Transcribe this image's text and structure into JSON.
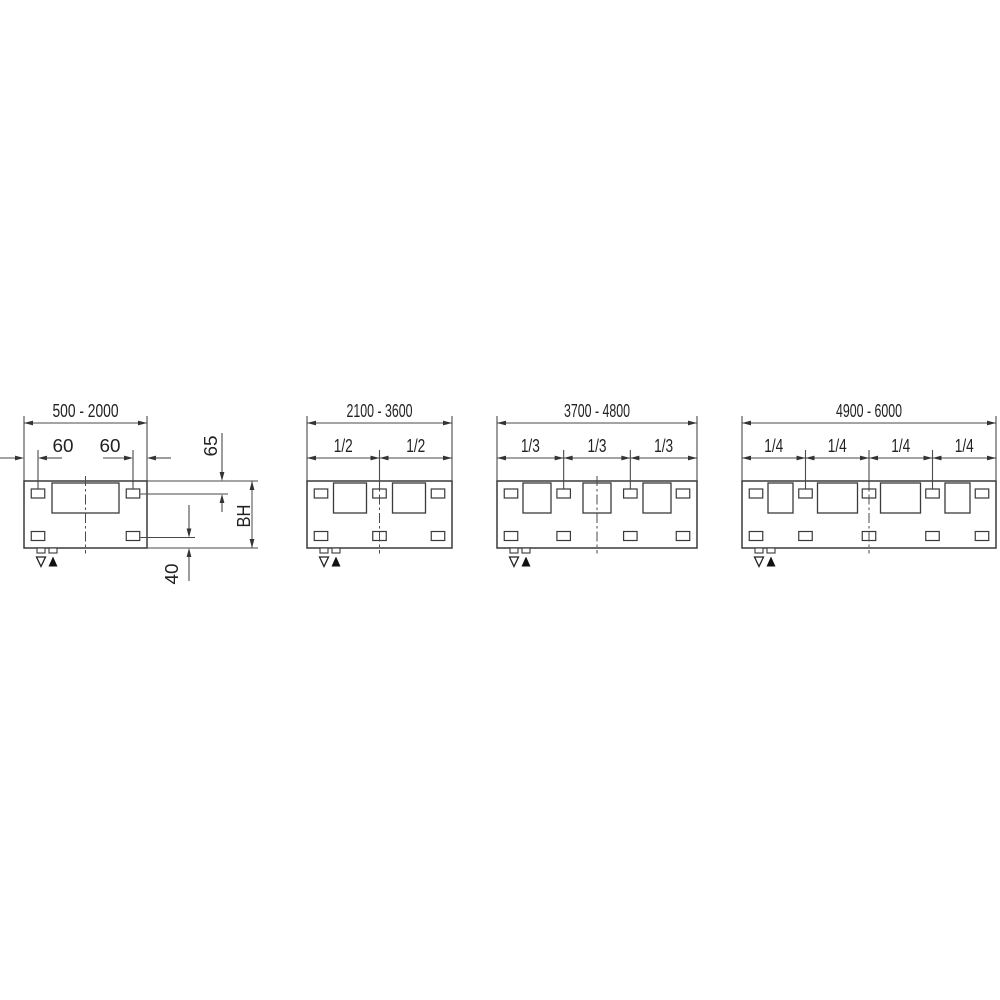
{
  "canvas": {
    "background": "#ffffff",
    "width_px": 1000,
    "height_px": 1000
  },
  "drawing": {
    "kind": "technical-dimension-drawing",
    "description": "Mounting dimension diagrams for four cabinet width ranges",
    "line_color": "#4a4a4a",
    "outline_color": "#3a3a3a",
    "text_color": "#222222",
    "symbols": {
      "open_triangle": "▽",
      "filled_triangle": "▲"
    },
    "diagrams": [
      {
        "width_range": "500 - 2000",
        "divisions": 1,
        "division_labels": [],
        "edge_hole_offsets": [
          "60",
          "60"
        ],
        "vertical_dims": {
          "top_edge_to_hole_center": "65",
          "body_height": "BH",
          "hole_center_to_bottom_edge": "40"
        },
        "openings": 1,
        "slots_top": 2,
        "slots_bottom": 2
      },
      {
        "width_range": "2100 - 3600",
        "divisions": 2,
        "division_labels": [
          "1/2",
          "1/2"
        ],
        "openings": 2,
        "slots_top": 3,
        "slots_bottom": 3
      },
      {
        "width_range": "3700 - 4800",
        "divisions": 3,
        "division_labels": [
          "1/3",
          "1/3",
          "1/3"
        ],
        "openings": 3,
        "slots_top": 4,
        "slots_bottom": 4
      },
      {
        "width_range": "4900 - 6000",
        "divisions": 4,
        "division_labels": [
          "1/4",
          "1/4",
          "1/4",
          "1/4"
        ],
        "openings": 4,
        "slots_top": 5,
        "slots_bottom": 5
      }
    ]
  }
}
